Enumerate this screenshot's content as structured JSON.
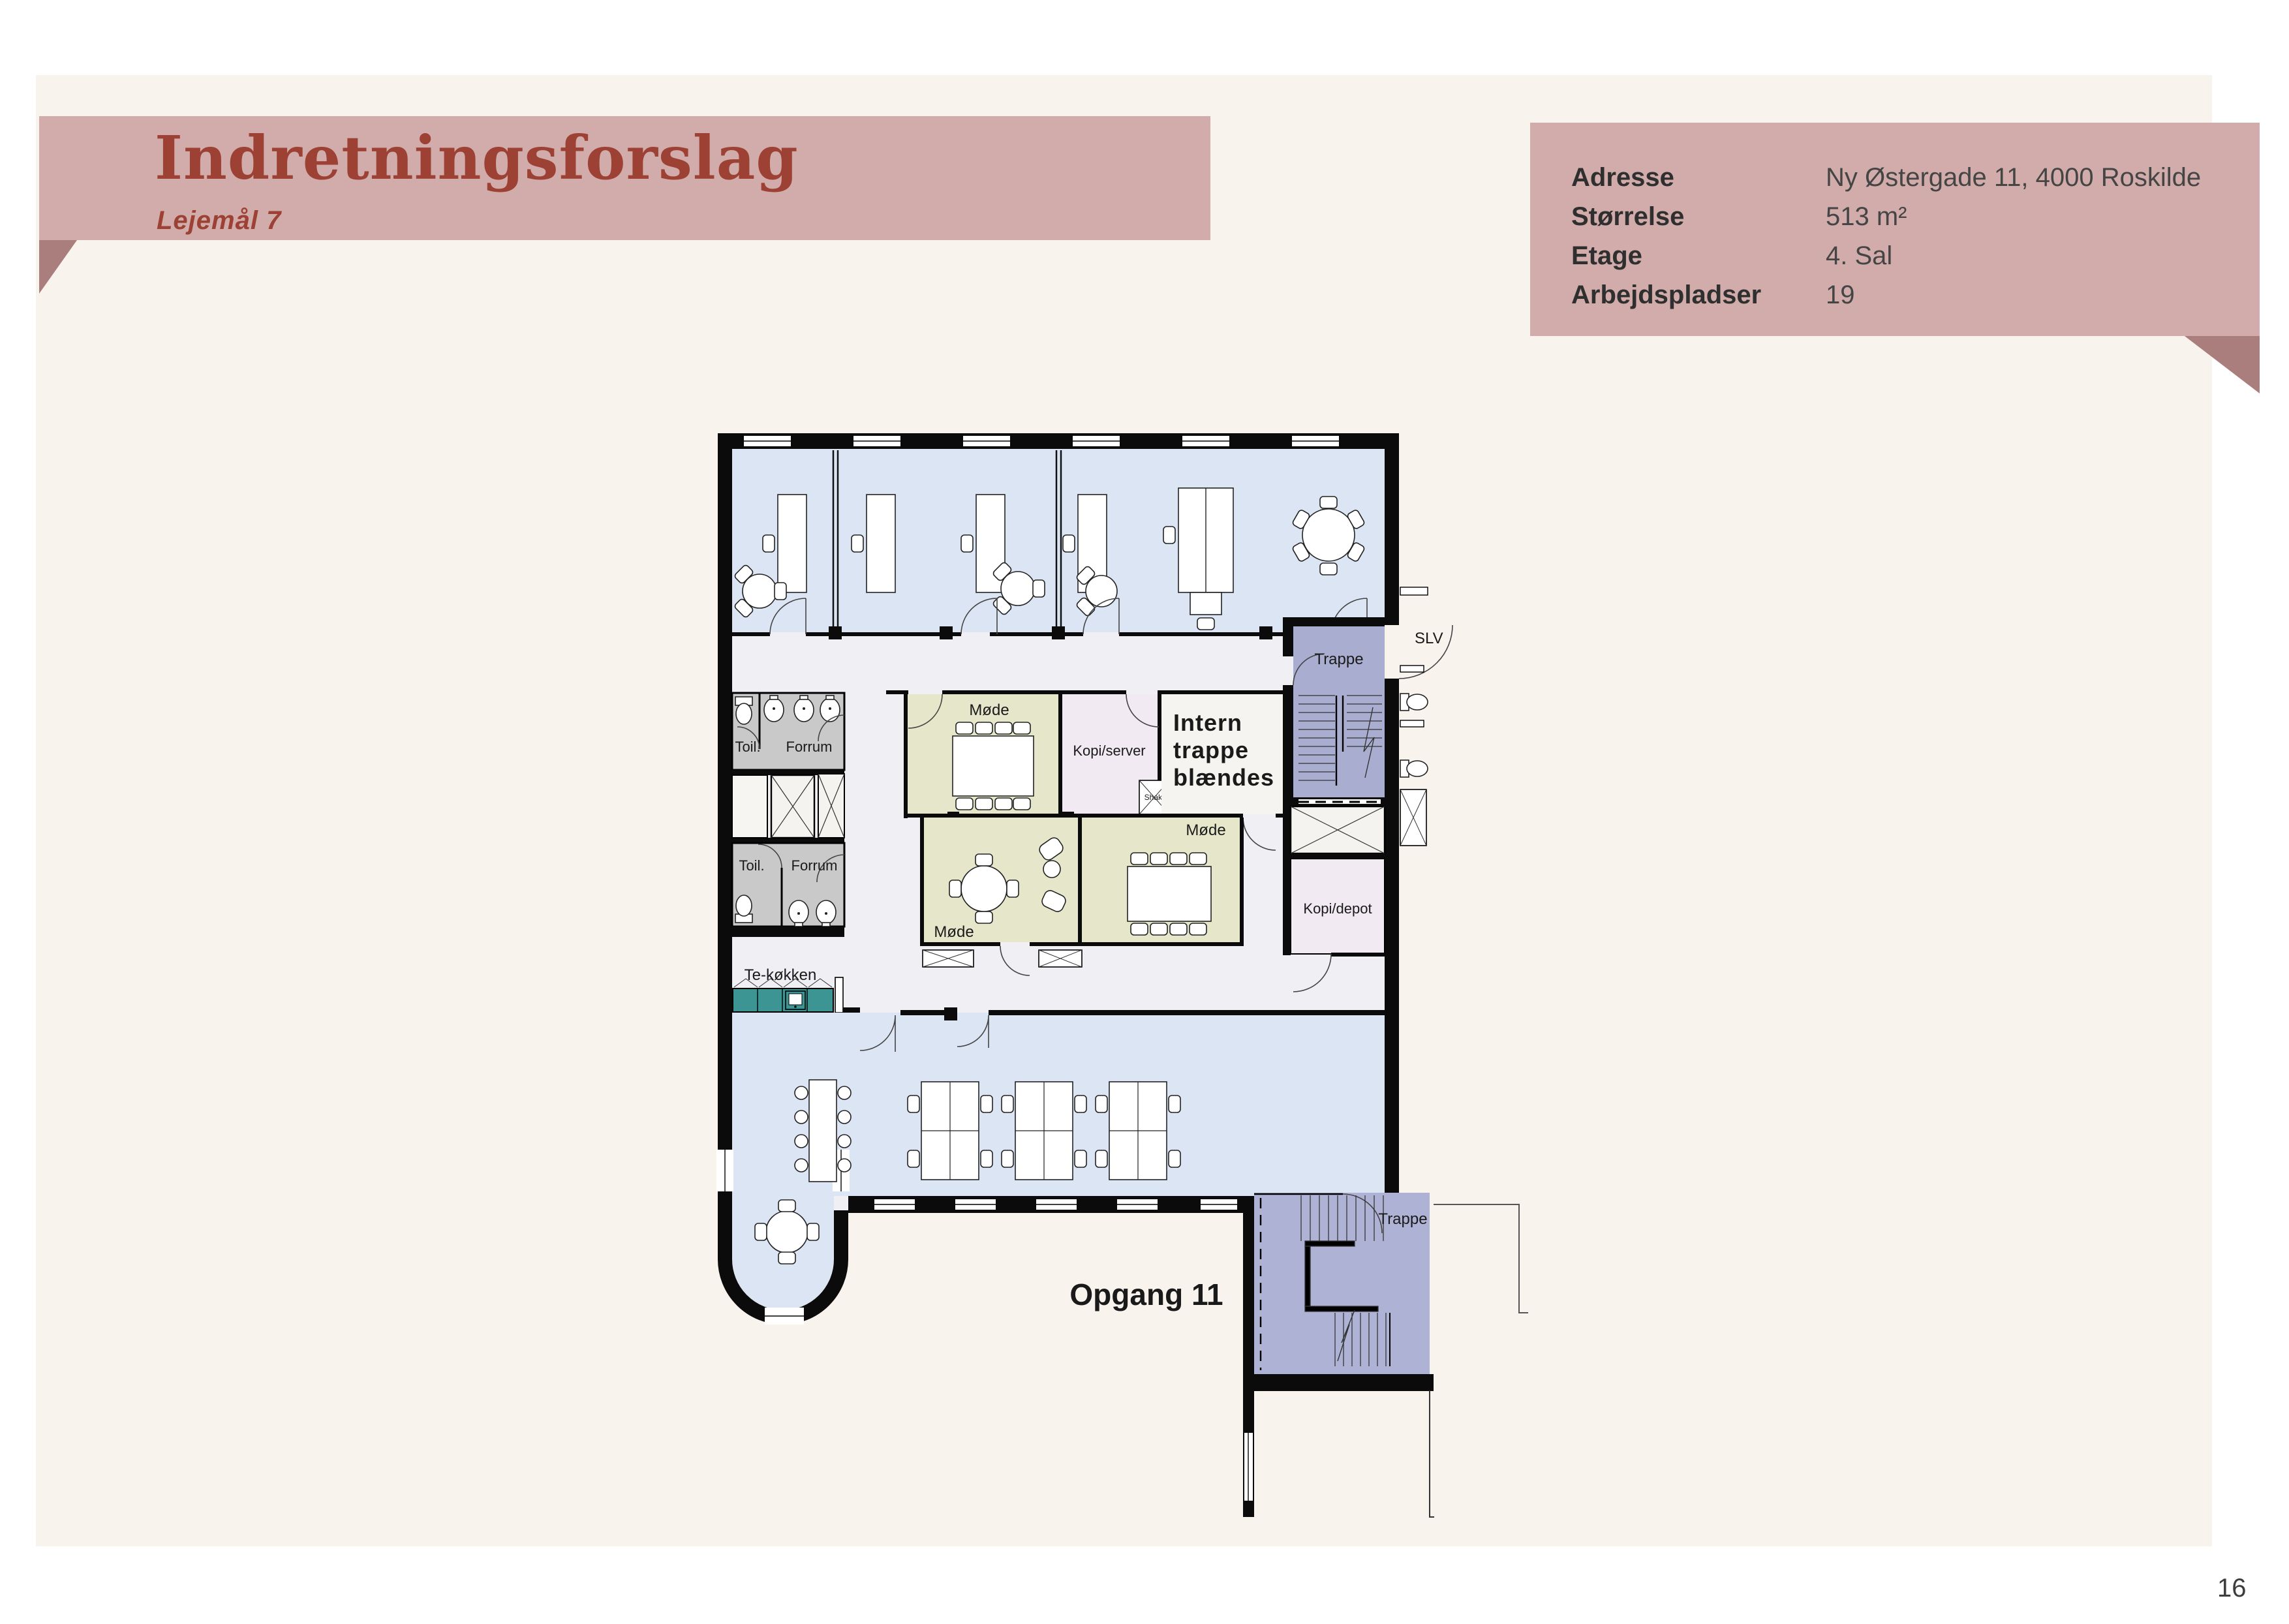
{
  "header": {
    "title": "Indretningsforslag",
    "subtitle": "Lejemål 7"
  },
  "info": {
    "rows": [
      {
        "label": "Adresse",
        "value": "Ny Østergade 11, 4000 Roskilde"
      },
      {
        "label": "Størrelse",
        "value": "513 m²"
      },
      {
        "label": "Etage",
        "value": "4. Sal"
      },
      {
        "label": "Arbejdspladser",
        "value": "19"
      }
    ]
  },
  "plan": {
    "labels": {
      "trappe_top": "Trappe",
      "trappe_bottom": "Trappe",
      "toil_upper": "Toil.",
      "forrum_upper": "Forrum",
      "toil_lower": "Toil.",
      "forrum_lower": "Forrum",
      "mode_top": "Møde",
      "mode_round": "Møde",
      "mode_right": "Møde",
      "kopi_server": "Kopi/server",
      "kopi_depot": "Kopi/depot",
      "intern_line1": "Intern",
      "intern_line2": "trappe",
      "intern_line3": "blændes",
      "tekokken": "Te-køkken",
      "opgang": "Opgang 11",
      "slv": "SLV",
      "shakt": "Shakt"
    }
  },
  "page_number": "16",
  "colors": {
    "banner": "#d1acaa",
    "banner_fold": "#aa7e7c",
    "accent_red": "#9c4134",
    "paper": "#f9f3ee",
    "plan_floor": "#f0eff3",
    "office_blue": "#dce5f4",
    "meeting_olive": "#e6e7ca",
    "stair_purple": "#a9aed1",
    "copy_pink": "#f2eaf3",
    "wc_gray": "#c9c9c9",
    "kitchen_teal": "#3d9593",
    "wall_black": "#0b0b0b"
  }
}
